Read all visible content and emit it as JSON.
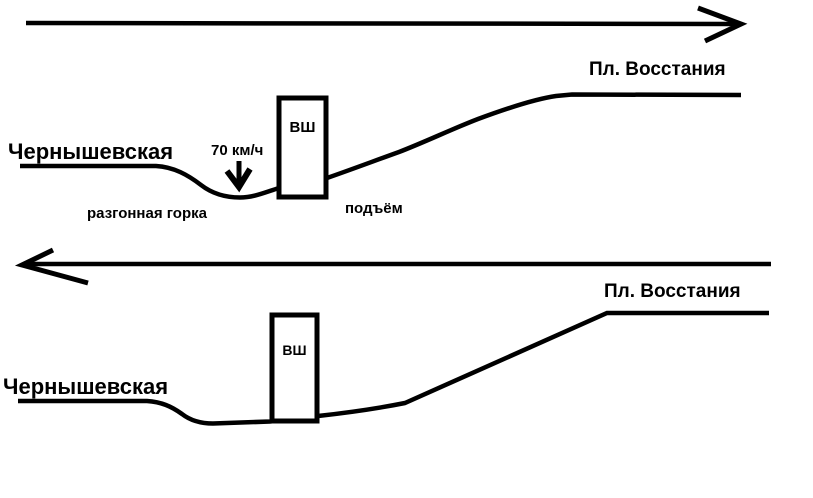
{
  "canvas": {
    "width": 813,
    "height": 498,
    "paper_color": "#ffffff",
    "ink_color": "#000000"
  },
  "top_profile": {
    "direction_arrow": "right",
    "left_station_label": "Чернышевская",
    "right_station_label": "Пл. Восстания",
    "vent_shaft_label": "ВШ",
    "speed_label": "70 км/ч",
    "hill_label": "разгонная горка",
    "climb_label": "подъём"
  },
  "bottom_profile": {
    "direction_arrow": "left",
    "left_station_label": "Чернышевская",
    "right_station_label": "Пл. Восстания",
    "vent_shaft_label": "ВШ"
  }
}
